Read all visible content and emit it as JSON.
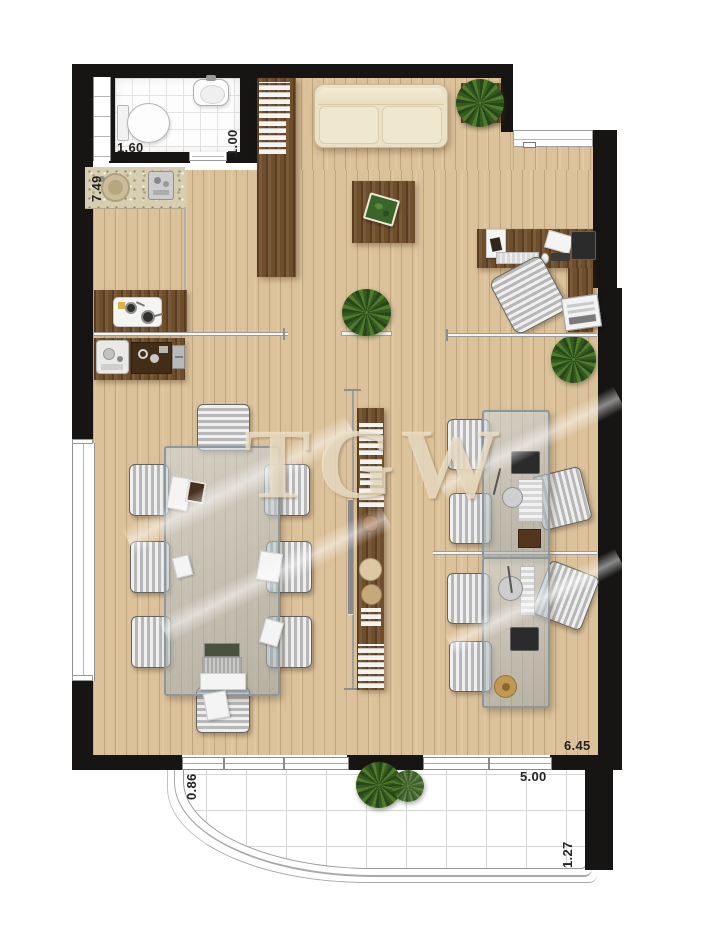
{
  "plan": {
    "watermark": "TGW",
    "labels": {
      "bath_width": "1.60",
      "bath_depth": "1.00",
      "left_length": "7.49",
      "balcony_left_depth": "0.86",
      "floor_width": "6.45",
      "balcony_width": "5.00",
      "balcony_right_depth": "1.27"
    },
    "palette": {
      "wall": "#161514",
      "floor": "#dcc29b",
      "dark_wood": "#6f4e2b",
      "glass": "#b9c3c7",
      "sofa": "#ebe1c6",
      "plant": "#3f6524",
      "tile": "#ffffff"
    }
  }
}
